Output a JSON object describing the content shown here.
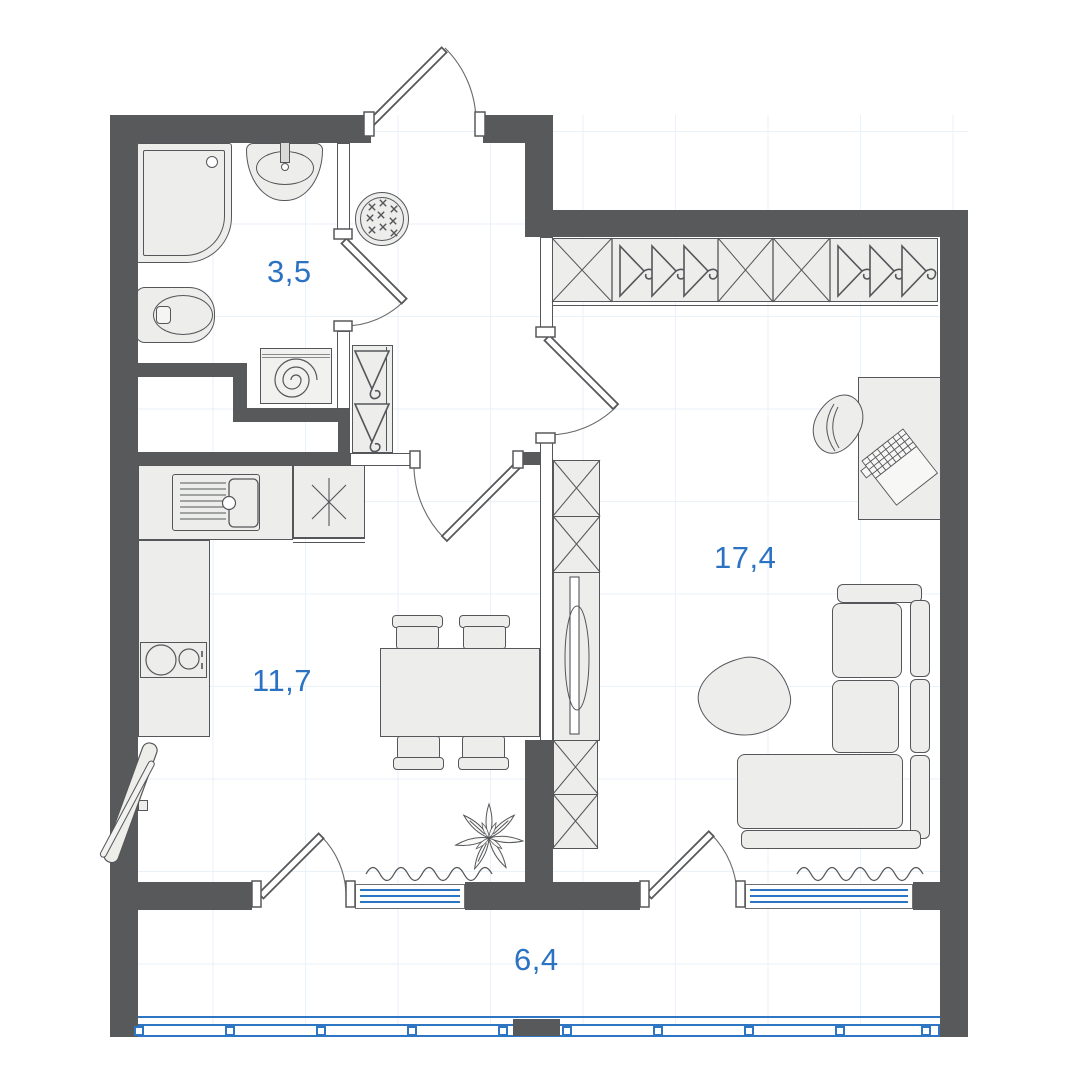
{
  "plan_type": "apartment-floor-plan",
  "rooms": [
    {
      "id": "bathroom",
      "area_label": "3,5"
    },
    {
      "id": "kitchen-dining",
      "area_label": "11,7"
    },
    {
      "id": "living-room",
      "area_label": "17,4"
    },
    {
      "id": "balcony",
      "area_label": "6,4"
    }
  ],
  "colors": {
    "wall": "#58595B",
    "furniture_fill": "#EDEDEB",
    "outline": "#55565A",
    "glazing_blue": "#2E75C4",
    "label_blue": "#2B72C2",
    "grid": "#E9F1FA",
    "background": "#FFFFFF"
  },
  "icons": {
    "shower-tray-icon": "rounded-corner-square-with-drain",
    "washbasin-icon": "oval-basin-with-faucet",
    "toilet-icon": "oval-bowl-with-cistern",
    "washing-machine-icon": "square-with-spiral-drum",
    "entry-mat-icon": "double-circle-with-crosses",
    "coat-hanger-icon": "triangle-with-hook",
    "wardrobe-box-icon": "crossed-shelf-box",
    "kitchen-sink-icon": "drainboard-and-bowl",
    "cooktop-icon": "two-burner-circles",
    "utility-asterisk-icon": "six-spoke-asterisk",
    "dining-table-icon": "rectangle-with-four-chairs",
    "tv-icon": "slim-panel-with-lens",
    "sofa-icon": "l-shaped-corner-sofa",
    "coffee-table-icon": "organic-blob-table",
    "desk-icon": "rectangle-desk",
    "office-chair-icon": "rounded-shell-chair",
    "laptop-icon": "hinged-keyboard-grid",
    "plant-icon": "leaf-rosette",
    "ironing-board-icon": "leaning-narrow-board",
    "curtain-icon": "wavy-line",
    "window-icon": "triple-blue-line-strip",
    "balcony-glazing-icon": "framed-blue-strip-with-mullions",
    "door-icon": "leaf-with-swing-arc"
  }
}
